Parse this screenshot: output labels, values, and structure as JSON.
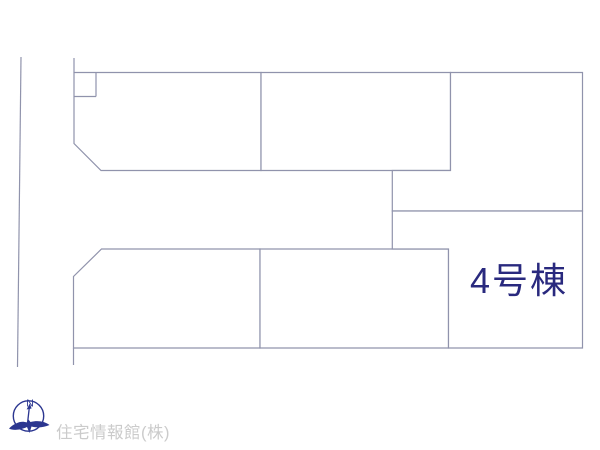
{
  "plan": {
    "highlight_label": "4号棟",
    "credit": "住宅情報館(株)",
    "compass": {
      "north_label": "N"
    },
    "colors": {
      "lot_outline": "#9093ac",
      "lot_fill": "#ffffff",
      "highlight_fill": "#f7d98e",
      "highlight_text": "#29297e",
      "logo": "#2b3690",
      "credit_text": "#cbcbcb"
    }
  }
}
